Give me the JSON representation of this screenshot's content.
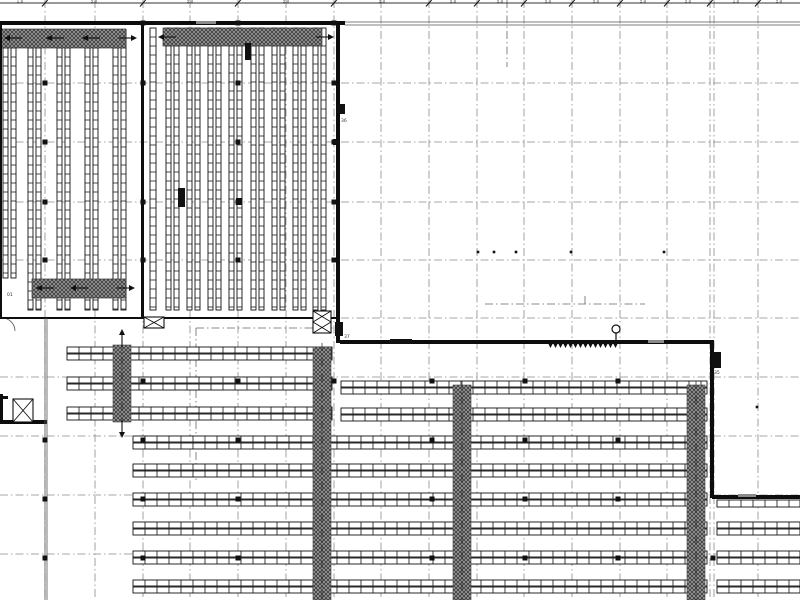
{
  "meta": {
    "width": 800,
    "height": 600,
    "bg": "#ffffff",
    "title": "Warehouse racking floor plan"
  },
  "colors": {
    "line": "#111111",
    "grid": "#8a8a8a",
    "wall": "#0d0d0d",
    "hatch_bg": "#979797",
    "hatch_line": "#2f2f2f",
    "label": "#444444",
    "thin": "#555555"
  },
  "grid": {
    "vx": [
      45,
      95,
      143,
      190,
      238,
      286,
      334,
      381,
      429,
      477,
      524,
      572,
      620,
      667,
      710,
      714,
      758
    ],
    "hy": [
      83,
      142,
      202,
      260,
      318,
      377,
      436,
      495,
      554
    ],
    "dash": "8 3 1.5 3"
  },
  "dimension": {
    "y": 3,
    "ticks": [
      45,
      143,
      238,
      334,
      429,
      477,
      524,
      572,
      620,
      667,
      710,
      758
    ],
    "labels": [
      {
        "x": 20,
        "t": "1,0"
      },
      {
        "x": 94,
        "t": "5,0"
      },
      {
        "x": 190,
        "t": "5,0"
      },
      {
        "x": 286,
        "t": "5,0"
      },
      {
        "x": 382,
        "t": "5,0"
      },
      {
        "x": 453,
        "t": "5,0"
      },
      {
        "x": 500,
        "t": "5,0"
      },
      {
        "x": 548,
        "t": "5,0"
      },
      {
        "x": 596,
        "t": "5,0"
      },
      {
        "x": 643,
        "t": "5,0"
      },
      {
        "x": 688,
        "t": "5,0"
      },
      {
        "x": 736,
        "t": "1,0"
      },
      {
        "x": 779,
        "t": "5,0"
      }
    ]
  },
  "walls": [
    {
      "x": 0,
      "y": 21,
      "w": 345,
      "h": 4,
      "name": "wall-top-west"
    },
    {
      "x": 0,
      "y": 23,
      "w": 2,
      "h": 296,
      "name": "wall-left"
    },
    {
      "x": 141,
      "y": 23,
      "w": 3,
      "h": 295,
      "name": "wall-block-divider"
    },
    {
      "x": 336,
      "y": 23,
      "w": 4,
      "h": 320,
      "name": "wall-midblock-east"
    },
    {
      "x": 0,
      "y": 317,
      "w": 340,
      "h": 2,
      "name": "wall-upper-hall-south"
    },
    {
      "x": 340,
      "y": 340,
      "w": 374,
      "h": 4,
      "name": "wall-dock-north"
    },
    {
      "x": 710,
      "y": 340,
      "w": 4,
      "h": 158,
      "name": "wall-east"
    },
    {
      "x": 712,
      "y": 495,
      "w": 88,
      "h": 4,
      "name": "wall-southeast"
    },
    {
      "x": 0,
      "y": 420,
      "w": 47,
      "h": 4,
      "name": "wall-shaft-south"
    },
    {
      "x": 0,
      "y": 396,
      "w": 8,
      "h": 3,
      "name": "wall-shaft-stub"
    },
    {
      "x": 0,
      "y": 394,
      "w": 3,
      "h": 30,
      "name": "wall-shaft-west"
    }
  ],
  "thin_double_lines": [
    {
      "x1": 345,
      "y1": 22,
      "x2": 800,
      "y2": 22
    },
    {
      "x1": 345,
      "y1": 25,
      "x2": 800,
      "y2": 25
    },
    {
      "x1": 45,
      "y1": 318,
      "x2": 45,
      "y2": 600
    },
    {
      "x1": 47,
      "y1": 318,
      "x2": 47,
      "y2": 600
    }
  ],
  "vracks": {
    "rail_w": 5,
    "cell_h": 9,
    "rails": [
      [
        3,
        30,
        278
      ],
      [
        11,
        30,
        278
      ],
      [
        28,
        30,
        310
      ],
      [
        36,
        30,
        310
      ],
      [
        57,
        30,
        310
      ],
      [
        65,
        30,
        310
      ],
      [
        85,
        30,
        310
      ],
      [
        93,
        30,
        310
      ],
      [
        113,
        30,
        310
      ],
      [
        121,
        30,
        310
      ],
      [
        150,
        28,
        310,
        6
      ],
      [
        166,
        28,
        310
      ],
      [
        174,
        28,
        310
      ],
      [
        187,
        28,
        310
      ],
      [
        195,
        28,
        310
      ],
      [
        208,
        28,
        310
      ],
      [
        216,
        28,
        310
      ],
      [
        229,
        28,
        310
      ],
      [
        237,
        28,
        310
      ],
      [
        251,
        28,
        310
      ],
      [
        259,
        28,
        310
      ],
      [
        272,
        28,
        310
      ],
      [
        280,
        28,
        310
      ],
      [
        293,
        28,
        310
      ],
      [
        301,
        28,
        310
      ],
      [
        313,
        28,
        310
      ],
      [
        321,
        28,
        310
      ]
    ]
  },
  "bands": [
    {
      "x": 0,
      "y": 29,
      "w": 126,
      "h": 19,
      "arrows": [
        {
          "x": 4,
          "y": 38,
          "d": "left"
        },
        {
          "x": 46,
          "y": 38,
          "d": "left"
        },
        {
          "x": 82,
          "y": 38,
          "d": "left"
        },
        {
          "x": 137,
          "y": 38,
          "d": "right"
        }
      ]
    },
    {
      "x": 32,
      "y": 279,
      "w": 94,
      "h": 19,
      "arrows": [
        {
          "x": 36,
          "y": 288,
          "d": "left"
        },
        {
          "x": 70,
          "y": 288,
          "d": "left"
        },
        {
          "x": 135,
          "y": 288,
          "d": "right"
        }
      ]
    },
    {
      "x": 163,
      "y": 28,
      "w": 159,
      "h": 18,
      "arrows": [
        {
          "x": 158,
          "y": 37,
          "d": "left"
        },
        {
          "x": 334,
          "y": 37,
          "d": "right"
        }
      ]
    }
  ],
  "hrows": {
    "rail_h": 6,
    "cell_w": 12,
    "rows": [
      {
        "x1": 67,
        "x2": 332,
        "y": 347
      },
      {
        "x1": 67,
        "x2": 332,
        "y": 377
      },
      {
        "x1": 67,
        "x2": 332,
        "y": 407
      },
      {
        "x1": 341,
        "x2": 707,
        "y": 381
      },
      {
        "x1": 341,
        "x2": 707,
        "y": 408
      },
      {
        "x1": 133,
        "x2": 707,
        "y": 436
      },
      {
        "x1": 133,
        "x2": 707,
        "y": 464
      },
      {
        "x1": 133,
        "x2": 707,
        "y": 493
      },
      {
        "x1": 133,
        "x2": 707,
        "y": 522
      },
      {
        "x1": 133,
        "x2": 707,
        "y": 551
      },
      {
        "x1": 133,
        "x2": 707,
        "y": 580
      },
      {
        "x1": 717,
        "x2": 800,
        "y": 500,
        "single": true
      },
      {
        "x1": 717,
        "x2": 800,
        "y": 522
      },
      {
        "x1": 717,
        "x2": 800,
        "y": 551
      },
      {
        "x1": 717,
        "x2": 800,
        "y": 580
      }
    ]
  },
  "hatch_cols": [
    {
      "x": 113,
      "y1": 345,
      "y2": 422,
      "w": 18,
      "arrow_up": true,
      "arrow_down": true
    },
    {
      "x": 313,
      "y1": 347,
      "y2": 600,
      "w": 18
    },
    {
      "x": 453,
      "y1": 385,
      "y2": 600,
      "w": 18
    },
    {
      "x": 687,
      "y1": 385,
      "y2": 600,
      "w": 18
    }
  ],
  "xboxes": [
    {
      "x": 144,
      "y": 317,
      "w": 20,
      "h": 11,
      "cells": 1
    },
    {
      "x": 313,
      "y": 311,
      "w": 18,
      "h": 22,
      "cells": 2
    },
    {
      "x": 13,
      "y": 399,
      "w": 20,
      "h": 23,
      "cells": 1
    }
  ],
  "black_marks": [
    {
      "x": 337,
      "y": 104,
      "w": 8,
      "h": 10,
      "label": "36",
      "lx": 341,
      "ly": 122
    },
    {
      "x": 335,
      "y": 322,
      "w": 8,
      "h": 14,
      "label": "37",
      "lx": 344,
      "ly": 338
    },
    {
      "x": 712,
      "y": 352,
      "w": 9,
      "h": 16,
      "label": "35",
      "lx": 714,
      "ly": 374
    },
    {
      "x": 178,
      "y": 188,
      "w": 7,
      "h": 19
    },
    {
      "x": 236,
      "y": 198,
      "w": 6,
      "h": 7
    },
    {
      "x": 245,
      "y": 43,
      "w": 6,
      "h": 17
    },
    {
      "x": 390,
      "y": 339,
      "w": 22,
      "h": 5
    },
    {
      "x": 155,
      "y": 21,
      "w": 24,
      "h": 4
    },
    {
      "x": 333,
      "y": 139,
      "w": 6,
      "h": 6
    }
  ],
  "gray_marks": [
    {
      "x": 648,
      "y": 340,
      "w": 16,
      "h": 3
    },
    {
      "x": 738,
      "y": 494,
      "w": 18,
      "h": 3
    },
    {
      "x": 196,
      "y": 21,
      "w": 20,
      "h": 3
    }
  ],
  "dock": {
    "teeth_x1": 548,
    "teeth_x2": 618,
    "teeth_y": 343,
    "tooth_w": 5,
    "tooth_h": 5,
    "circle": {
      "cx": 616,
      "cy": 329,
      "r": 4
    },
    "stem": {
      "x1": 616,
      "y1": 333,
      "x2": 616,
      "y2": 341
    }
  },
  "column_dots": [
    [
      143,
      23
    ],
    [
      238,
      23
    ],
    [
      334,
      23
    ],
    [
      45,
      83
    ],
    [
      143,
      83
    ],
    [
      238,
      83
    ],
    [
      334,
      83
    ],
    [
      45,
      142
    ],
    [
      238,
      142
    ],
    [
      334,
      142
    ],
    [
      45,
      202
    ],
    [
      143,
      202
    ],
    [
      238,
      202
    ],
    [
      334,
      202
    ],
    [
      45,
      260
    ],
    [
      143,
      260
    ],
    [
      238,
      260
    ],
    [
      334,
      260
    ],
    [
      143,
      381
    ],
    [
      238,
      381
    ],
    [
      334,
      381
    ],
    [
      432,
      381
    ],
    [
      525,
      381
    ],
    [
      618,
      381
    ],
    [
      45,
      440
    ],
    [
      143,
      440
    ],
    [
      238,
      440
    ],
    [
      432,
      440
    ],
    [
      525,
      440
    ],
    [
      618,
      440
    ],
    [
      45,
      499
    ],
    [
      143,
      499
    ],
    [
      238,
      499
    ],
    [
      432,
      499
    ],
    [
      525,
      499
    ],
    [
      618,
      499
    ],
    [
      45,
      558
    ],
    [
      143,
      558
    ],
    [
      238,
      558
    ],
    [
      432,
      558
    ],
    [
      525,
      558
    ],
    [
      618,
      558
    ],
    [
      713,
      558
    ]
  ],
  "small_dots": [
    [
      478,
      252
    ],
    [
      494,
      252
    ],
    [
      516,
      252
    ],
    [
      571,
      252
    ],
    [
      664,
      252
    ],
    [
      757,
      407
    ]
  ],
  "dashdot_extra": [
    {
      "x1": 485,
      "y1": 304,
      "x2": 645,
      "y2": 304
    },
    {
      "x1": 585,
      "y1": 296,
      "x2": 585,
      "y2": 304
    },
    {
      "x1": 507,
      "y1": 0,
      "x2": 507,
      "y2": 67
    },
    {
      "x1": 196,
      "y1": 328,
      "x2": 336,
      "y2": 328
    },
    {
      "x1": 196,
      "y1": 328,
      "x2": 196,
      "y2": 480
    }
  ],
  "door_arc": {
    "d": "M 2 318 A 13 13 0 0 1 15 331"
  },
  "texts": [
    {
      "x": 7,
      "y": 296,
      "t": "01"
    }
  ]
}
